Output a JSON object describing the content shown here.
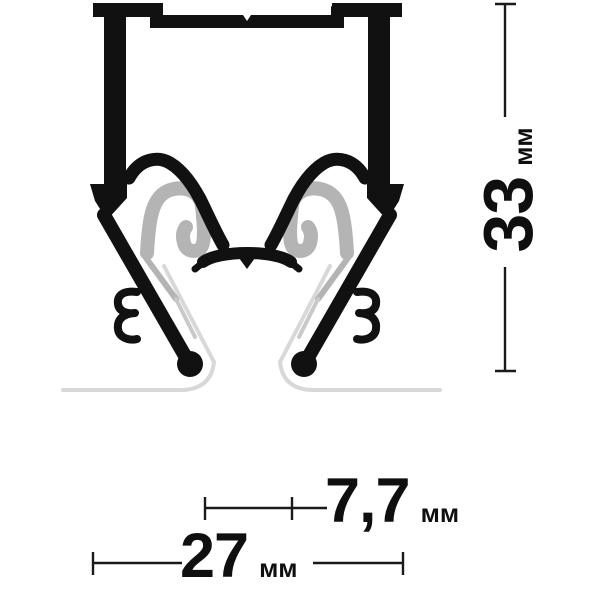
{
  "diagram": {
    "kind": "technical-profile-cross-section",
    "units": "мм"
  },
  "dimensions": {
    "height": {
      "value": "33",
      "unit": "мм"
    },
    "inner_gap": {
      "value": "7,7",
      "unit": "мм"
    },
    "width": {
      "value": "27",
      "unit": "мм"
    }
  },
  "colors": {
    "profile_black": "#111111",
    "insert_gray": "#b4b4b4",
    "insert_tail_light": "#c9c9c9",
    "cover_line_gray": "#d8d8d8",
    "dimension_line": "#1a1a1a",
    "background": "#ffffff"
  }
}
